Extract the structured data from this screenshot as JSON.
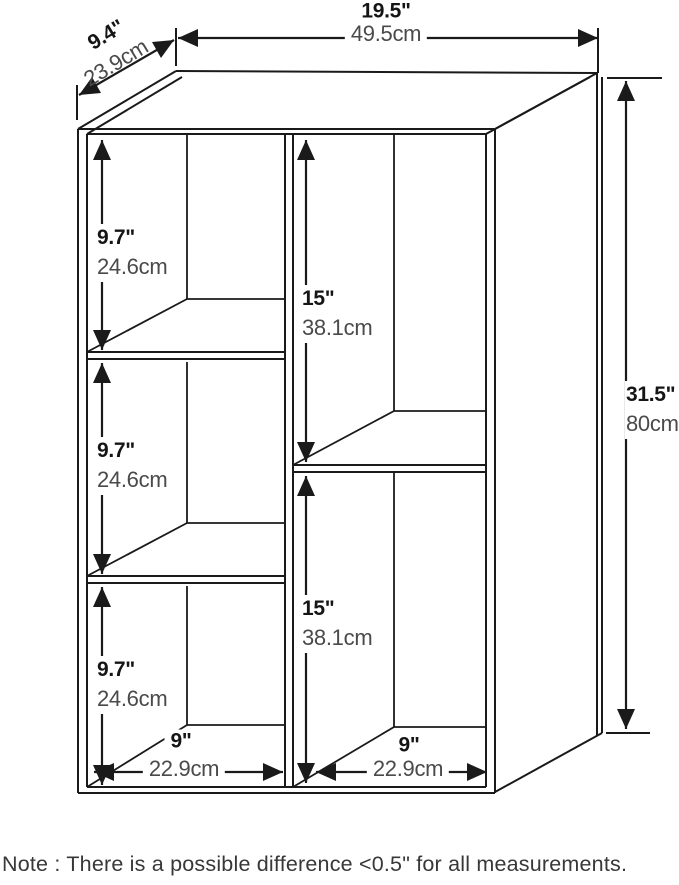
{
  "labels": {
    "width_in": "19.5\"",
    "width_cm": "49.5cm",
    "depth_in": "9.4\"",
    "depth_cm": "23.9cm",
    "height_in": "31.5\"",
    "height_cm": "80cm",
    "left1_in": "9.7\"",
    "left1_cm": "24.6cm",
    "left2_in": "9.7\"",
    "left2_cm": "24.6cm",
    "left3_in": "9.7\"",
    "left3_cm": "24.6cm",
    "mid1_in": "15\"",
    "mid1_cm": "38.1cm",
    "mid2_in": "15\"",
    "mid2_cm": "38.1cm",
    "bottom_left_in": "9\"",
    "bottom_left_cm": "22.9cm",
    "bottom_right_in": "9\"",
    "bottom_right_cm": "22.9cm"
  },
  "note": "Note : There is a possible difference <0.5\" for all measurements.",
  "colors": {
    "line": "#1a1a1a",
    "inch_text": "#151515",
    "cm_text": "#4a4a4a",
    "note_text": "#383838",
    "background": "#ffffff"
  }
}
